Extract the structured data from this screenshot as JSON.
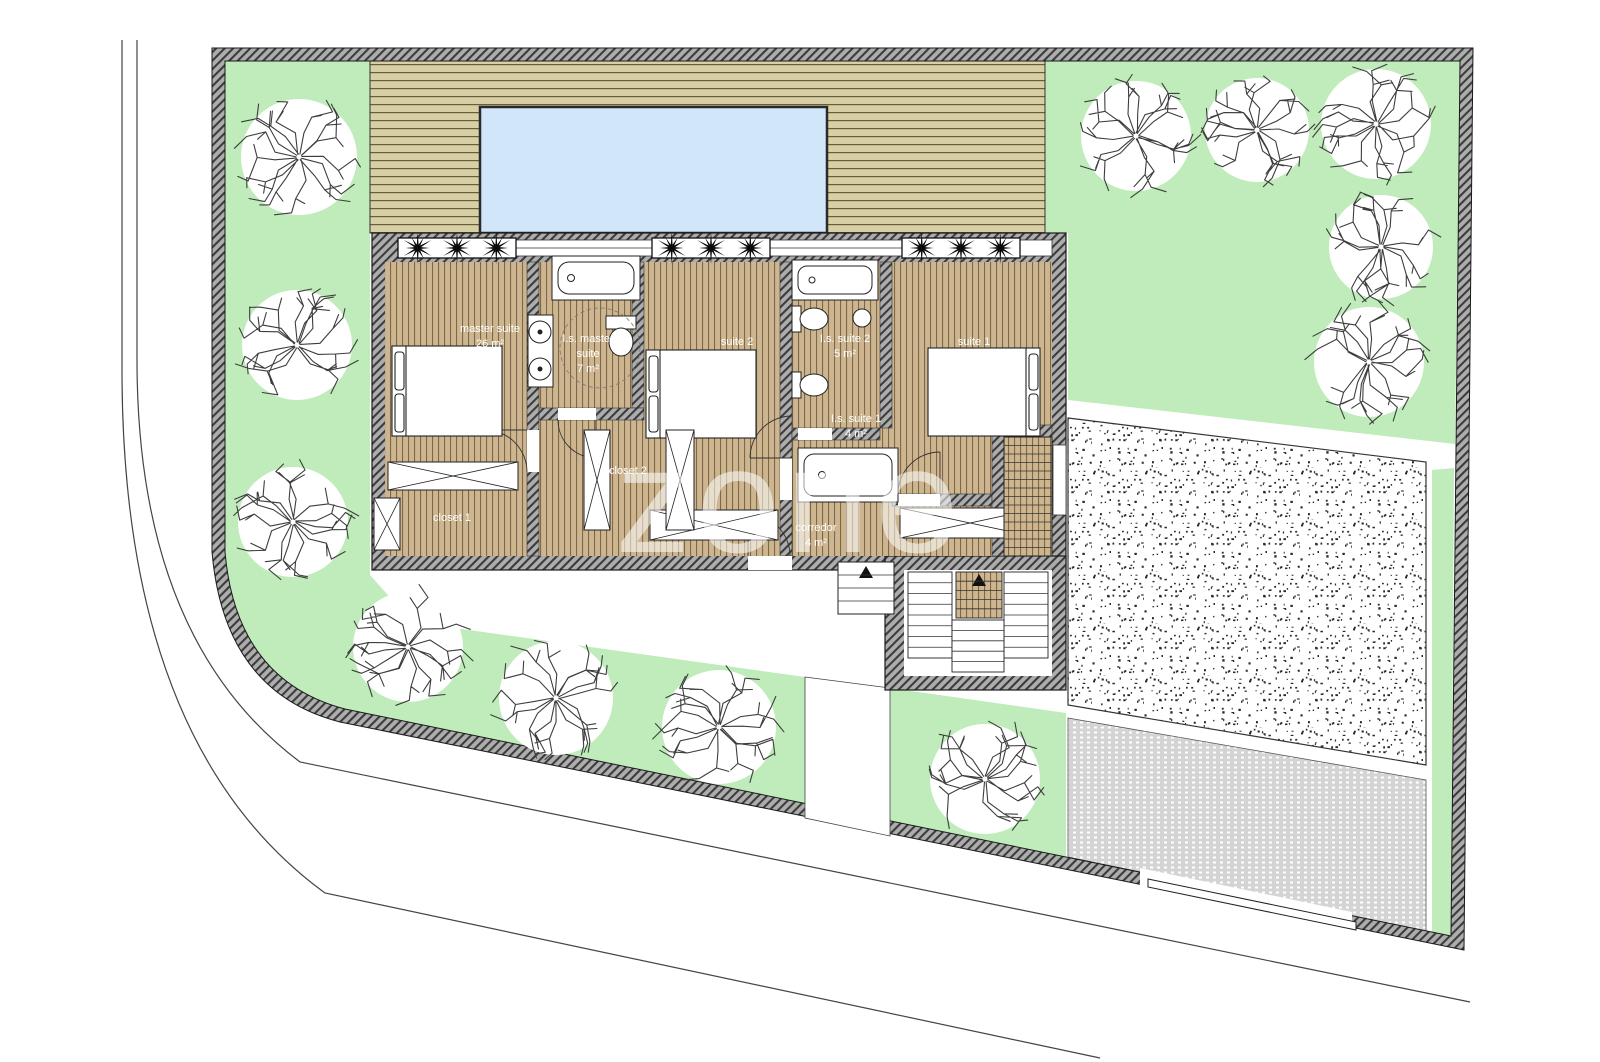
{
  "plan": {
    "title": "Floor plan - upper floor site plan",
    "watermark": "zone",
    "rooms": [
      {
        "id": "master-suite",
        "label": "master suite",
        "label2": "",
        "area": "26 m²",
        "x": 490,
        "y": 332
      },
      {
        "id": "is-master-suite",
        "label": "I.s. master",
        "label2": "suite",
        "area": "7 m²",
        "x": 588,
        "y": 342
      },
      {
        "id": "suite-2",
        "label": "suite 2",
        "label2": "",
        "area": "14 m²",
        "x": 737,
        "y": 345
      },
      {
        "id": "is-suite-2",
        "label": "I.s. suite 2",
        "label2": "",
        "area": "5 m²",
        "x": 845,
        "y": 342
      },
      {
        "id": "suite-1",
        "label": "suite 1",
        "label2": "",
        "area": "14 m²",
        "x": 974,
        "y": 345
      },
      {
        "id": "is-suite-1",
        "label": "I.s. suite 1",
        "label2": "",
        "area": "4 m²",
        "x": 856,
        "y": 422
      },
      {
        "id": "closet-2",
        "label": "closet 2",
        "label2": "",
        "area": "",
        "x": 628,
        "y": 474
      },
      {
        "id": "closet-1",
        "label": "closet 1",
        "label2": "",
        "area": "",
        "x": 452,
        "y": 521
      },
      {
        "id": "corredor",
        "label": "corredor",
        "label2": "",
        "area": "4 m²",
        "x": 816,
        "y": 531
      }
    ],
    "features": [
      "swimming-pool",
      "wood-deck",
      "lawn",
      "gravel-area",
      "paver-driveway",
      "sliding-gate",
      "pedestrian-gate",
      "stairs",
      "planter-boxes"
    ],
    "colors": {
      "lawn": "#bfecba",
      "deck": "#d8cfa4",
      "deck_line": "#5b5331",
      "wood_floor": "#cdb58f",
      "wood_line": "#6e5b41",
      "pool": "#d2e6f9",
      "wall": "#adadad",
      "wall_line": "#3c3c3c",
      "paver": "#d4d4d4",
      "ink": "#222222",
      "label": "#ffffff"
    },
    "trees": [
      {
        "x": 299,
        "y": 157,
        "r": 58
      },
      {
        "x": 297,
        "y": 345,
        "r": 55
      },
      {
        "x": 293,
        "y": 522,
        "r": 55
      },
      {
        "x": 408,
        "y": 647,
        "r": 55
      },
      {
        "x": 556,
        "y": 698,
        "r": 57
      },
      {
        "x": 719,
        "y": 727,
        "r": 57
      },
      {
        "x": 985,
        "y": 779,
        "r": 55
      },
      {
        "x": 1136,
        "y": 136,
        "r": 55
      },
      {
        "x": 1257,
        "y": 130,
        "r": 52
      },
      {
        "x": 1376,
        "y": 124,
        "r": 55
      },
      {
        "x": 1381,
        "y": 247,
        "r": 52
      },
      {
        "x": 1369,
        "y": 362,
        "r": 55
      }
    ],
    "planter_rows": [
      {
        "x": 398,
        "y": 238,
        "w": 118,
        "h": 20,
        "plants": 3
      },
      {
        "x": 652,
        "y": 238,
        "w": 118,
        "h": 20,
        "plants": 3
      },
      {
        "x": 902,
        "y": 238,
        "w": 118,
        "h": 20,
        "plants": 3
      }
    ]
  }
}
